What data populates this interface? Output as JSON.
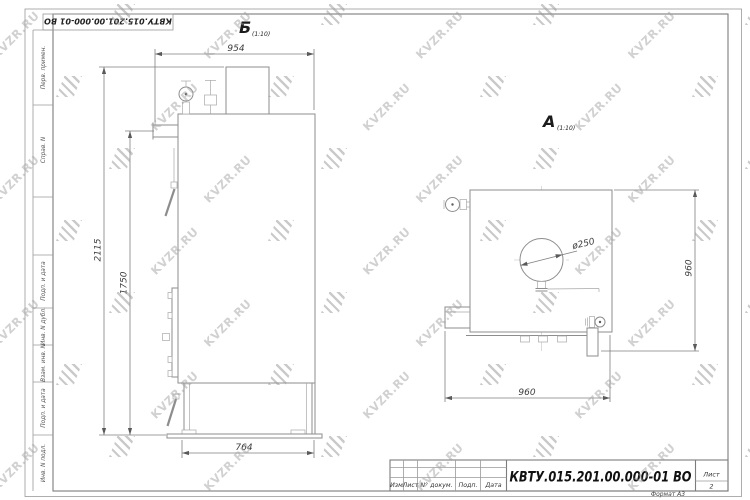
{
  "watermark": {
    "text": "KVZR.RU"
  },
  "top_stamp": {
    "doc_number": "КВТУ.015.201.00.000-01 ВО"
  },
  "sidebar": {
    "labels": [
      "Перв. примен.",
      "Справ. N",
      "Подп. и дата",
      "Инв. N дубл.",
      "Взам. инв. N",
      "Подп. и дата",
      "Инв. N подл."
    ]
  },
  "views": {
    "left": {
      "label": "Б",
      "scale": "(1:10)",
      "dims": {
        "top_width": "954",
        "total_height": "2115",
        "body_height": "1750",
        "bottom_width": "764"
      }
    },
    "right": {
      "label": "А",
      "scale": "(1:10)",
      "dims": {
        "diameter": "ø250",
        "height": "960",
        "width": "960"
      }
    }
  },
  "title_block": {
    "columns": [
      "Изм",
      "Лист",
      "N° докум.",
      "Подп.",
      "Дата"
    ],
    "doc_number": "КВТУ.015.201.00.000-01 ВО",
    "sheet_label": "Лист",
    "sheet_number": "2",
    "format": "Формат А3"
  }
}
